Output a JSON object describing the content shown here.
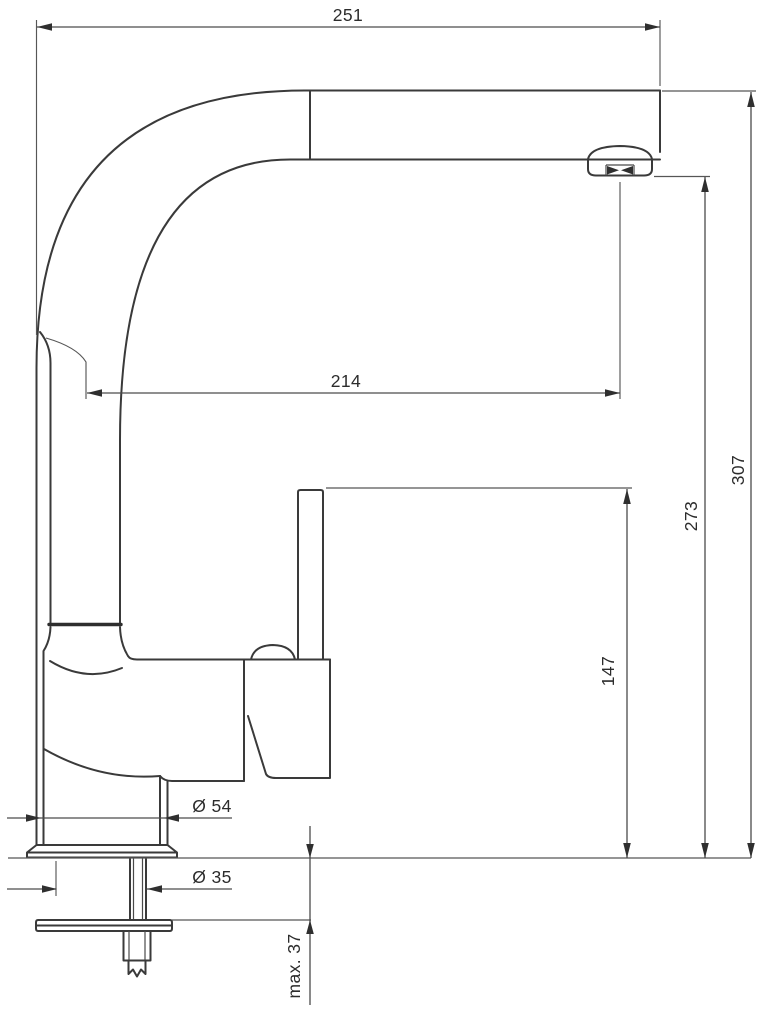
{
  "drawing": {
    "subject": "single-lever kitchen mixer tap, side elevation technical drawing",
    "background_color": "#ffffff",
    "object_line_color": "#3a3a3a",
    "dimension_line_color": "#4c4c4c",
    "units": "mm"
  },
  "dimensions": {
    "total_width": "251",
    "spout_reach": "214",
    "total_height": "307",
    "outlet_height": "273",
    "handle_height": "147",
    "base_diameter": "Ø 54",
    "shank_diameter": "Ø 35",
    "max_counter_thickness": "max. 37"
  }
}
